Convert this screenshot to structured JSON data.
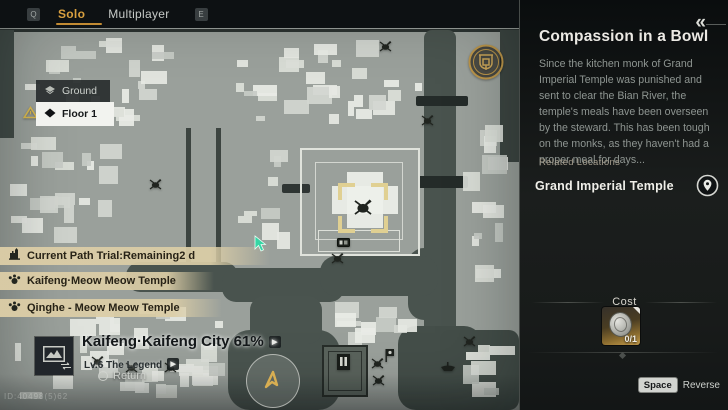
{
  "top_bar": {
    "left_key": "Q",
    "right_key": "E",
    "tabs": [
      {
        "label": "Solo",
        "active": true
      },
      {
        "label": "Multiplayer",
        "active": false
      }
    ]
  },
  "floor_selector": {
    "options": [
      {
        "label": "Ground",
        "active": false
      },
      {
        "label": "Floor 1",
        "active": true
      }
    ]
  },
  "quest_tracker": [
    {
      "icon": "tower-icon",
      "label": "Current Path Trial:Remaining2 d"
    },
    {
      "icon": "paw-icon",
      "label": "Kaifeng·Meow Meow Temple"
    },
    {
      "icon": "paw-icon",
      "label": "Qinghe - Meow Meow Temple"
    }
  ],
  "region_info": {
    "title": "Kaifeng·Kaifeng City 61%",
    "level": "Lv.6 The Legend",
    "return_label": "Return",
    "watermark": "ID:40498(5)62"
  },
  "quest_panel": {
    "title": "Compassion in a Bowl",
    "description": "Since the kitchen monk of Grand Imperial Temple was punished and sent to clear the Bian River, the temple's meals have been overseen by the steward. This has been tough on the monks, as they haven't had a proper meal for days...",
    "related_label": "Related Locations",
    "locations": [
      {
        "name": "Grand Imperial Temple"
      }
    ],
    "cost": {
      "label": "Cost",
      "count": "0/1"
    },
    "footer": {
      "key": "Space",
      "action": "Reverse"
    }
  },
  "icons": {
    "arrow_right": "▶",
    "collapse": "«"
  },
  "colors": {
    "accent_gold": "#d9a03f",
    "quest_bar": "#dbcda6",
    "map_base": "#9aa09b",
    "water": "#49534e",
    "panel_bg": "#141717"
  },
  "map_icons": [
    {
      "type": "spider",
      "x": 148,
      "y": 178
    },
    {
      "type": "spider",
      "x": 420,
      "y": 114
    },
    {
      "type": "spider",
      "x": 378,
      "y": 40
    },
    {
      "type": "spider",
      "x": 330,
      "y": 252
    },
    {
      "type": "spider",
      "x": 90,
      "y": 355
    },
    {
      "type": "spider",
      "x": 124,
      "y": 361
    },
    {
      "type": "spider",
      "x": 163,
      "y": 361
    },
    {
      "type": "spider",
      "x": 370,
      "y": 357
    },
    {
      "type": "spider",
      "x": 371,
      "y": 374
    },
    {
      "type": "spider",
      "x": 462,
      "y": 335
    },
    {
      "type": "sign",
      "x": 337,
      "y": 238
    },
    {
      "type": "gate",
      "x": 336,
      "y": 353
    },
    {
      "type": "banner",
      "x": 384,
      "y": 348
    },
    {
      "type": "boat",
      "x": 440,
      "y": 361
    },
    {
      "type": "emblem",
      "x": 468,
      "y": 44
    },
    {
      "type": "warning",
      "x": 23,
      "y": 106
    }
  ]
}
